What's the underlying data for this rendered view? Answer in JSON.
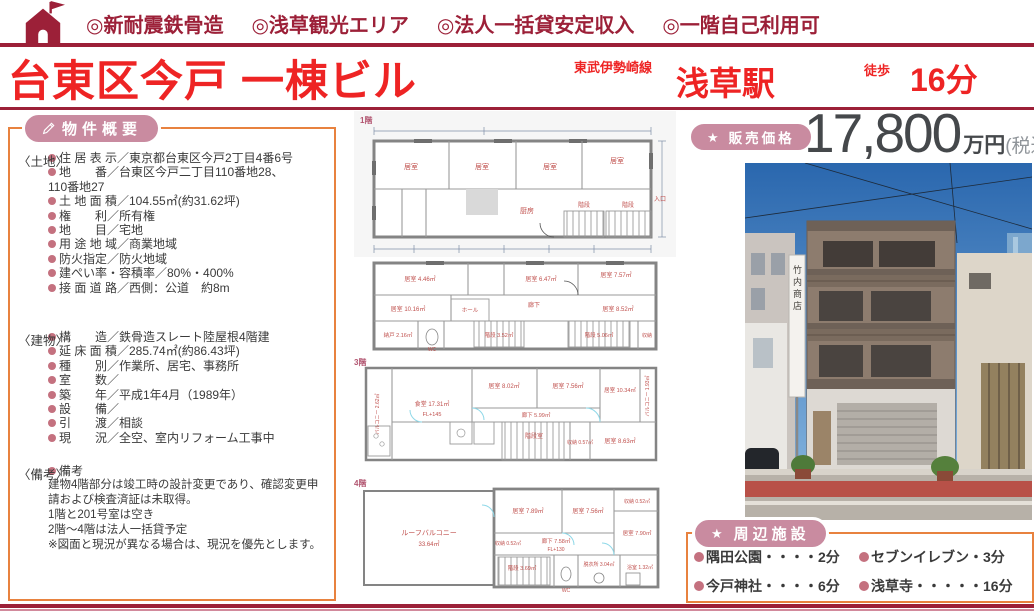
{
  "header": {
    "catchphrases": [
      "◎新耐震鉄骨造",
      "◎浅草観光エリア",
      "◎法人一括貸安定収入",
      "◎一階自己利用可"
    ],
    "title": "台東区今戸 一棟ビル",
    "rail_line": "東武伊勢崎線",
    "station": "浅草駅",
    "walk_label": "徒歩",
    "walk_time": "16分"
  },
  "overview": {
    "badge": "物件概要",
    "land": {
      "heading": "〈土地〉",
      "items": [
        "住 居 表 示／東京都台東区今戸2丁目4番6号",
        "地　　番／台東区今戸二丁目110番地28、",
        "土 地 面 積／104.55㎡(約31.62坪)",
        "権　　利／所有権",
        "地　　目／宅地",
        "用 途 地 域／商業地域",
        "防火指定／防火地域",
        "建ぺい率・容積率／80%・400%",
        "接 面 道 路／西側：公道　約8m"
      ],
      "continuation": "110番地27"
    },
    "building": {
      "heading": "〈建物〉",
      "items": [
        "構　　造／鉄骨造スレート陸屋根4階建",
        "延 床 面 積／285.74㎡(約86.43坪)",
        "種　　別／作業所、居宅、事務所",
        "室　　数／",
        "築　　年／平成1年4月（1989年）",
        "設　　備／",
        "引　　渡／相談",
        "現　　況／全空、室内リフォーム工事中"
      ]
    },
    "remarks": {
      "heading": "〈備考〉",
      "bullet": "備考",
      "lines": [
        "建物4階部分は竣工時の設計変更であり、確認変更申請および検査済証は未取得。",
        "1階と201号室は空き",
        "2階～4階は法人一括貸予定",
        "※図面と現況が異なる場合は、現況を優先とします。"
      ]
    }
  },
  "price": {
    "badge": "販売価格",
    "amount": "17,800",
    "unit": "万円",
    "tax": "(税込)"
  },
  "photo": {
    "sign_text": "竹内商店"
  },
  "nearby": {
    "badge": "周辺施設",
    "items": [
      "隅田公園・・・・2分",
      "セブンイレブン・3分",
      "今戸神社・・・・6分",
      "浅草寺・・・・・16分"
    ]
  },
  "floorplans": {
    "p1": {
      "label": "1階",
      "rooms": [
        "居室",
        "居室",
        "居室",
        "居室",
        "厨房",
        "階段",
        "階段",
        "入口"
      ]
    },
    "p2": {
      "rooms": [
        "居室 4.46㎡",
        "居室 6.47㎡",
        "居室 7.57㎡",
        "居室 10.16㎡",
        "居室 8.52㎡",
        "廊下",
        "ホール",
        "納戸 2.16㎡",
        "WC",
        "階段 3.52㎡",
        "階段 5.06㎡",
        "収納"
      ]
    },
    "p3": {
      "label": "3階",
      "rooms": [
        "食堂 17.31㎡",
        "FL+145",
        "居室 8.02㎡",
        "居室 7.56㎡",
        "居室 10.34㎡",
        "廊下 5.99㎡",
        "階段室",
        "居室 8.63㎡",
        "収納 0.57㎡",
        "バルコニー 2.62㎡",
        "バルコニー 1.93㎡"
      ]
    },
    "p4": {
      "label": "4階",
      "rooms": [
        "ルーフバルコニー",
        "33.64㎡",
        "居室 7.89㎡",
        "居室 7.56㎡",
        "居室 7.90㎡",
        "収納 0.52㎡",
        "廊下 7.58㎡",
        "FL+130",
        "階段 3.69㎡",
        "WC",
        "脱衣所 3.04㎡",
        "浴室 1.32㎡",
        "収納 0.52㎡"
      ]
    }
  },
  "colors": {
    "crimson": "#9c2038",
    "bright_red": "#ee2424",
    "badge_pink": "#c98ba0",
    "panel_border_orange": "#e8823f",
    "bullet_rose": "#c4717f",
    "price_text": "#45484b",
    "plan_text_red": "#c0504d"
  }
}
